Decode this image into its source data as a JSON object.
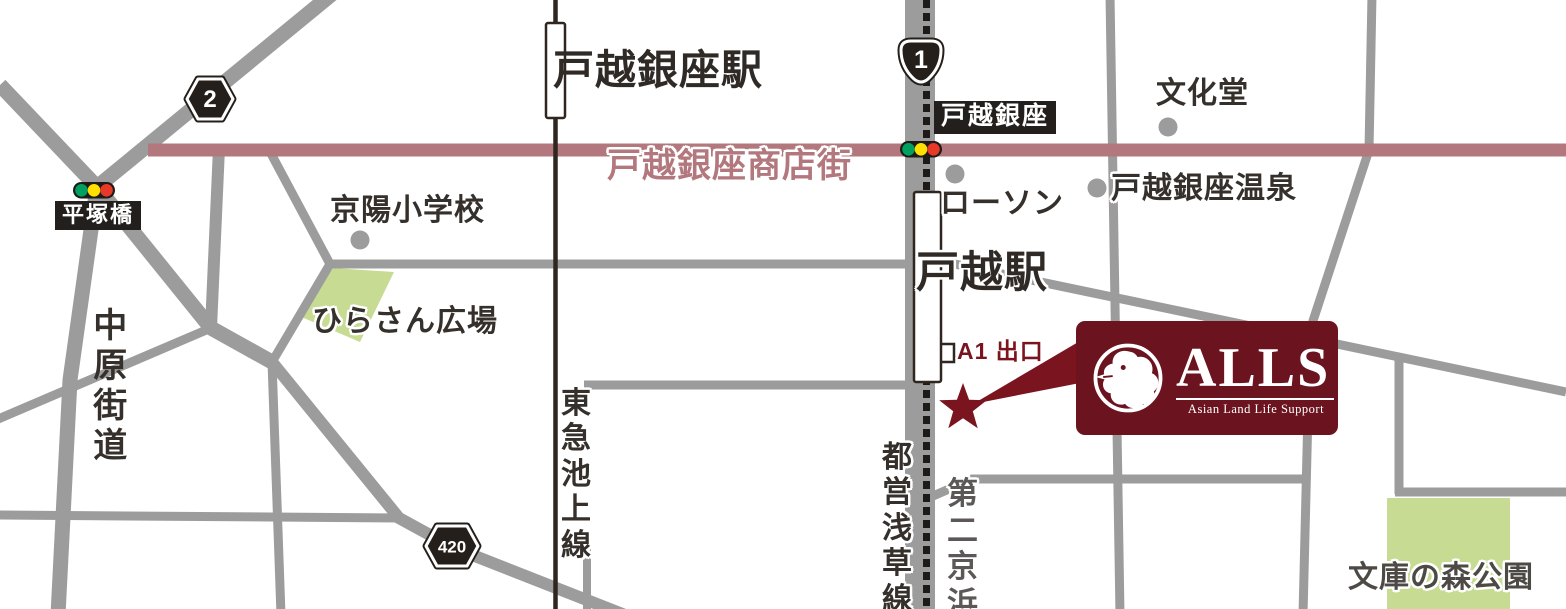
{
  "map": {
    "stations": {
      "togoshi_ginza_station": "戸越銀座駅",
      "togoshi_station": "戸越駅"
    },
    "railways": {
      "ikegami_line": "東急池上線",
      "asakusa_line": "都営浅草線"
    },
    "roads": {
      "shopping_street": "戸越銀座商店街",
      "nakahara_kaido": "中原街道",
      "dai_ni_keihin": "第二京浜"
    },
    "route_badges": {
      "route_1": "1",
      "route_2": "2",
      "route_420": "420"
    },
    "signal_labels": {
      "hiratsukabashi": "平塚橋",
      "togoshi_ginza": "戸越銀座"
    },
    "landmarks": {
      "keiyo_elementary": "京陽小学校",
      "hirasan_plaza": "ひらさん広場",
      "lawson": "ローソン",
      "bunkado": "文化堂",
      "togoshi_ginza_onsen": "戸越銀座温泉",
      "bunko_no_mori_park": "文庫の森公園"
    },
    "exit": {
      "a1": "A1 出口"
    },
    "logo": {
      "title": "ALLS",
      "subtitle": "Asian Land Life Support"
    },
    "colors": {
      "brand_maroon": "#6b141f",
      "accent_maroon": "#7a1520",
      "street_rose": "#b2787d",
      "road_gray": "#9c9c9c",
      "rail_dark": "#2f2620",
      "dash_black": "#1e1a17",
      "park_green": "#c7db93",
      "badge_black": "#241f1b",
      "signal_green": "#00a160",
      "signal_yellow": "#ffe000",
      "signal_red": "#e73828"
    }
  }
}
